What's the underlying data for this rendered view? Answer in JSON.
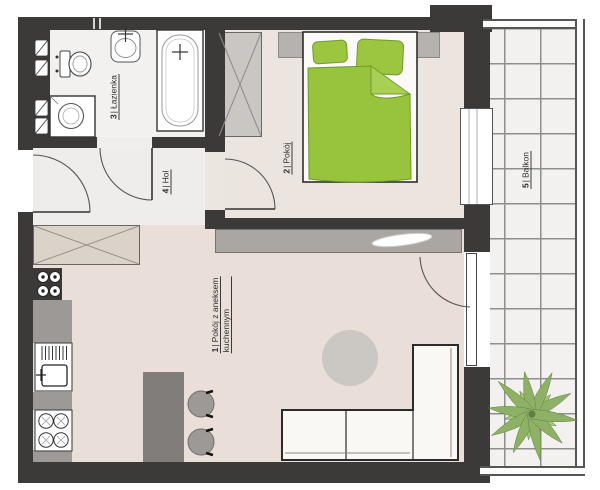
{
  "label_separator": "|",
  "rooms": [
    {
      "number": "1",
      "name": "Pokój z aneksem",
      "name2": "kuchennym"
    },
    {
      "number": "2",
      "name": "Pokój"
    },
    {
      "number": "3",
      "name": "Łazienka"
    },
    {
      "number": "4",
      "name": "Hol"
    },
    {
      "number": "5",
      "name": "Balkon"
    }
  ],
  "fixtures": [
    "bathtub",
    "washbasin",
    "toilet",
    "washing-machine",
    "utility-shaft",
    "meter-symbols",
    "hall-wardrobe",
    "bedroom-wardrobe",
    "double-bed",
    "pillows",
    "duvet",
    "nightstand-left",
    "nightstand-right",
    "sideboard",
    "decor-object",
    "kitchen-counter",
    "dish-drainer",
    "kitchen-sink",
    "stove",
    "kitchen-island",
    "bar-stool",
    "round-rug",
    "corner-sofa",
    "entry-door",
    "bathroom-door",
    "bedroom-door",
    "balcony-door",
    "bedroom-window",
    "balcony-tiles",
    "balcony-railing",
    "palm-plant"
  ],
  "colors": {
    "wall": "#3c3a39",
    "bedding_green": "#97c43c",
    "pillow_green": "#9cc63f",
    "floor_living": "#e9dfd8",
    "floor_bedroom": "#ece4de",
    "floor_hall": "#efedeb",
    "floor_bathroom": "#f2f1ef",
    "balcony_tile": "#f2f1ef",
    "grid_line": "#8e8e8e",
    "furniture_gray": "#a9a6a3",
    "island_gray": "#807d7a",
    "palm_green": "#8fb166"
  }
}
